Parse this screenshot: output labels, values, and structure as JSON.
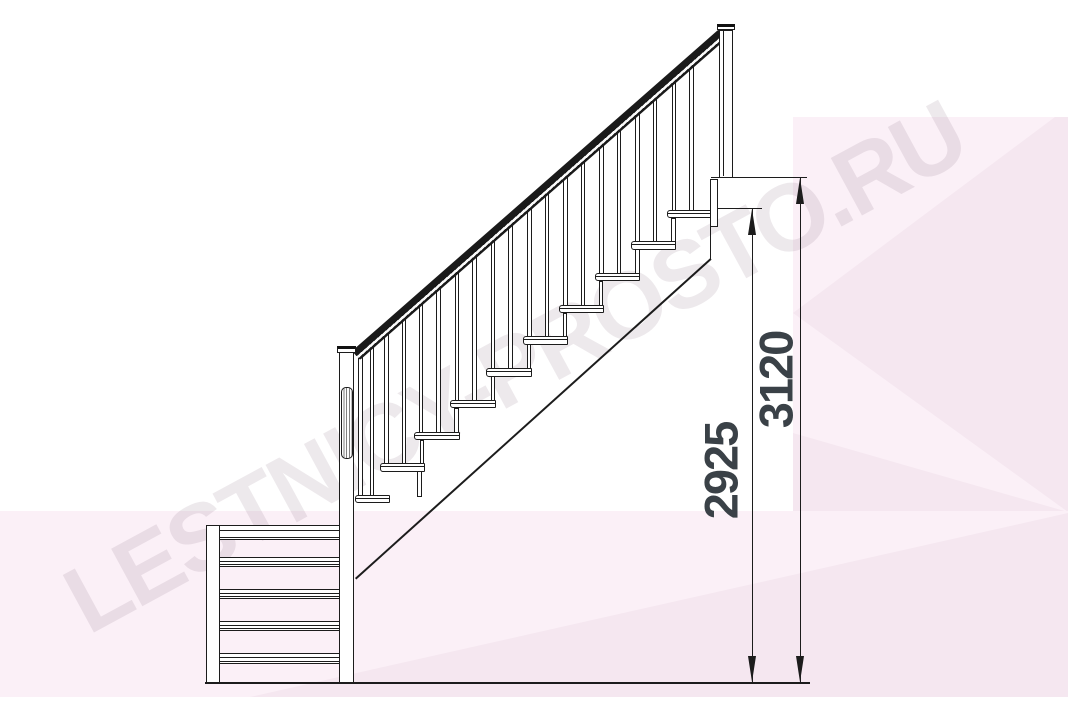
{
  "title": "Staircase side elevation technical drawing",
  "watermark": {
    "text": "LESTNICY-PROSTO.RU"
  },
  "dimension_labels": {
    "flight_height": "2925",
    "total_height": "3120"
  },
  "colors": {
    "line": "#1c1c1c",
    "dim_text": "#3a4147",
    "pink_light": "#fbf0f7",
    "pink_deep": "#f5e7f0",
    "watermark": "rgba(125,100,120,0.14)",
    "white": "#ffffff"
  },
  "figure": {
    "rail": {
      "x": 351.5,
      "y": 350.5,
      "len": 487.5,
      "thick": 12,
      "angle": -41.25
    },
    "stringer": {
      "x": 355,
      "y": 578,
      "len": 478,
      "thick": 1.6,
      "angle": -42
    },
    "rail_bottom_base": 361.5,
    "rail_slope": 0.877,
    "tread_w": 45.5,
    "tread_h": 8.5,
    "baluster_w": 4.6,
    "baluster_offsets": [
      4.5,
      22
    ],
    "treads": [
      {
        "x": 667.0,
        "y": 209.5
      },
      {
        "x": 630.9,
        "y": 241.2
      },
      {
        "x": 594.8,
        "y": 272.9
      },
      {
        "x": 558.7,
        "y": 304.6
      },
      {
        "x": 522.6,
        "y": 336.3
      },
      {
        "x": 486.4,
        "y": 368.1
      },
      {
        "x": 450.3,
        "y": 399.8
      },
      {
        "x": 414.2,
        "y": 431.5
      },
      {
        "x": 379.5,
        "y": 463.0
      },
      {
        "x": 355.0,
        "y": 494.5,
        "w": 35,
        "bo": [
          3,
          14.5
        ],
        "sx": 417
      }
    ],
    "bands": [
      {
        "x": 205.5,
        "y": 524.5,
        "w": 134,
        "h": 15.5,
        "lines": [
          4,
          11
        ]
      },
      {
        "x": 205.5,
        "y": 556.5,
        "w": 134,
        "h": 10,
        "lines": [
          3,
          6.5
        ]
      },
      {
        "x": 205.5,
        "y": 588.5,
        "w": 134,
        "h": 10,
        "lines": [
          3,
          6.5
        ]
      },
      {
        "x": 205.5,
        "y": 620.5,
        "w": 148.5,
        "h": 10,
        "lines": [
          3,
          6.5
        ]
      },
      {
        "x": 205.5,
        "y": 653.0,
        "w": 148.5,
        "h": 11,
        "lines": [
          3,
          7
        ]
      }
    ],
    "dots": [
      [
        211.5,
        536.5
      ],
      [
        211.5,
        677.0
      ],
      [
        344.5,
        465.5
      ]
    ],
    "dims": [
      {
        "x": 751.5,
        "y1": 209,
        "y2": 682,
        "ext": {
          "x1": 713,
          "x2": 761.5,
          "y": 207.8
        }
      },
      {
        "x": 799.5,
        "y1": 178,
        "y2": 682
      }
    ]
  }
}
